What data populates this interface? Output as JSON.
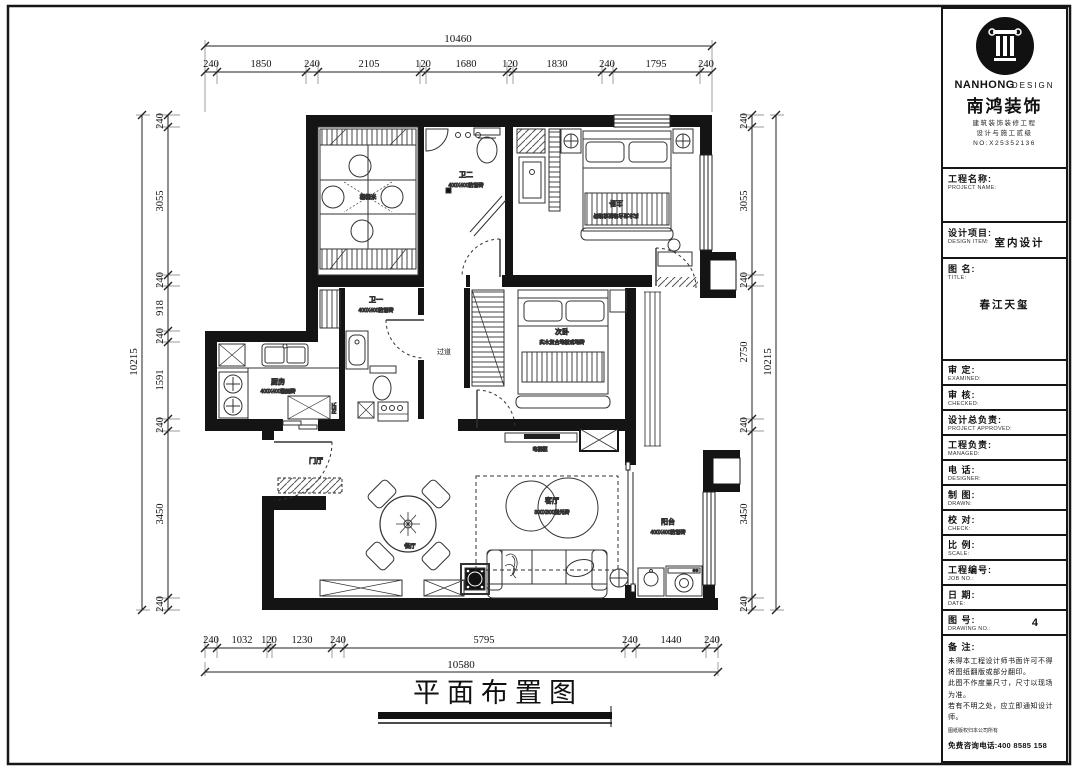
{
  "drawing": {
    "title": "平面布置图"
  },
  "dims": {
    "top": {
      "overall": "10460",
      "segments": [
        "240",
        "1850",
        "240",
        "2105",
        "120",
        "1680",
        "120",
        "1830",
        "240",
        "1795",
        "240"
      ]
    },
    "bottom": {
      "overall": "10580",
      "segments": [
        "240",
        "1032",
        "120",
        "1230",
        "240",
        "5795",
        "240",
        "1440",
        "240"
      ]
    },
    "left": {
      "overall": "10215",
      "segments": [
        "240",
        "3055",
        "240",
        "918",
        "240",
        "1591",
        "240",
        "3450",
        "240"
      ]
    },
    "right": {
      "overall": "10215",
      "segments": [
        "240",
        "3055",
        "240",
        "2750",
        "240",
        "3450",
        "240"
      ]
    }
  },
  "plan": {
    "rooms": {
      "tatami": {
        "name": "榻榻米"
      },
      "bath2": {
        "name": "卫二",
        "spec": "400X400防滑砖"
      },
      "master": {
        "name": "主卧",
        "spec": "实木复合地板或地砖"
      },
      "kitchen": {
        "name": "厨房",
        "spec": "400X400釉面砖"
      },
      "bath1": {
        "name": "卫一",
        "spec": "400X400防滑砖"
      },
      "corridor": {
        "name": "过道"
      },
      "bedroom2": {
        "name": "次卧",
        "spec": "实木复合地板或地砖"
      },
      "entry": {
        "name": "门厅"
      },
      "living": {
        "name": "客厅",
        "spec": "800X800抛光砖"
      },
      "balcony": {
        "name": "阳台",
        "spec": "400X400防滑砖"
      }
    },
    "labels": {
      "tv_cabinet": "电视柜",
      "fridge": "REF.",
      "dining": "餐厅"
    }
  },
  "logo": {
    "brand_en_1": "NANHONG",
    "brand_en_2": "DESIGN",
    "brand_cn": "南鸿装饰",
    "sub_line_1": "建筑装饰装修工程",
    "sub_line_2": "设计与施工贰级",
    "sub_line_3": "NO:X25352136"
  },
  "titleblock": {
    "sections": {
      "project_name": {
        "cn": "工程名称:",
        "en": "PROJECT NAME:"
      },
      "design_item": {
        "cn": "设计项目:",
        "en": "DESIGN ITEM:",
        "value": "室内设计"
      },
      "drawing_title": {
        "cn": "图  名:",
        "en": "TITLE:",
        "value": "春江天玺"
      }
    },
    "rows": [
      {
        "cn": "审  定:",
        "en": "EXAMINED:"
      },
      {
        "cn": "审  核:",
        "en": "CHECKED:"
      },
      {
        "cn": "设计总负责:",
        "en": "PROJECT APPROVED:"
      },
      {
        "cn": "工程负责:",
        "en": "MANAGED:"
      },
      {
        "cn": "电  话:",
        "en": "DESIGNER:"
      },
      {
        "cn": "制  图:",
        "en": "DRAWN:"
      },
      {
        "cn": "校  对:",
        "en": "CHECK:"
      },
      {
        "cn": "比  例:",
        "en": "SCALE:"
      },
      {
        "cn": "工程编号:",
        "en": "JOB NO.:"
      },
      {
        "cn": "日  期:",
        "en": "DATE:"
      },
      {
        "cn": "图  号:",
        "en": "DRAWING NO.:",
        "value": "4"
      }
    ],
    "notes": {
      "cn": "备  注:",
      "line1": "未得本工程设计师书面许可不得",
      "line2": "将图纸翻版或部分翻印。",
      "line3": "此图不作度量尺寸，尺寸以现场",
      "line4": "为准。",
      "line5": "若有不明之处，应立即通知设计",
      "line6": "师。",
      "copyright": "图纸版权归本公司所有",
      "hotline": "免费咨询电话:400 8585 158"
    }
  }
}
